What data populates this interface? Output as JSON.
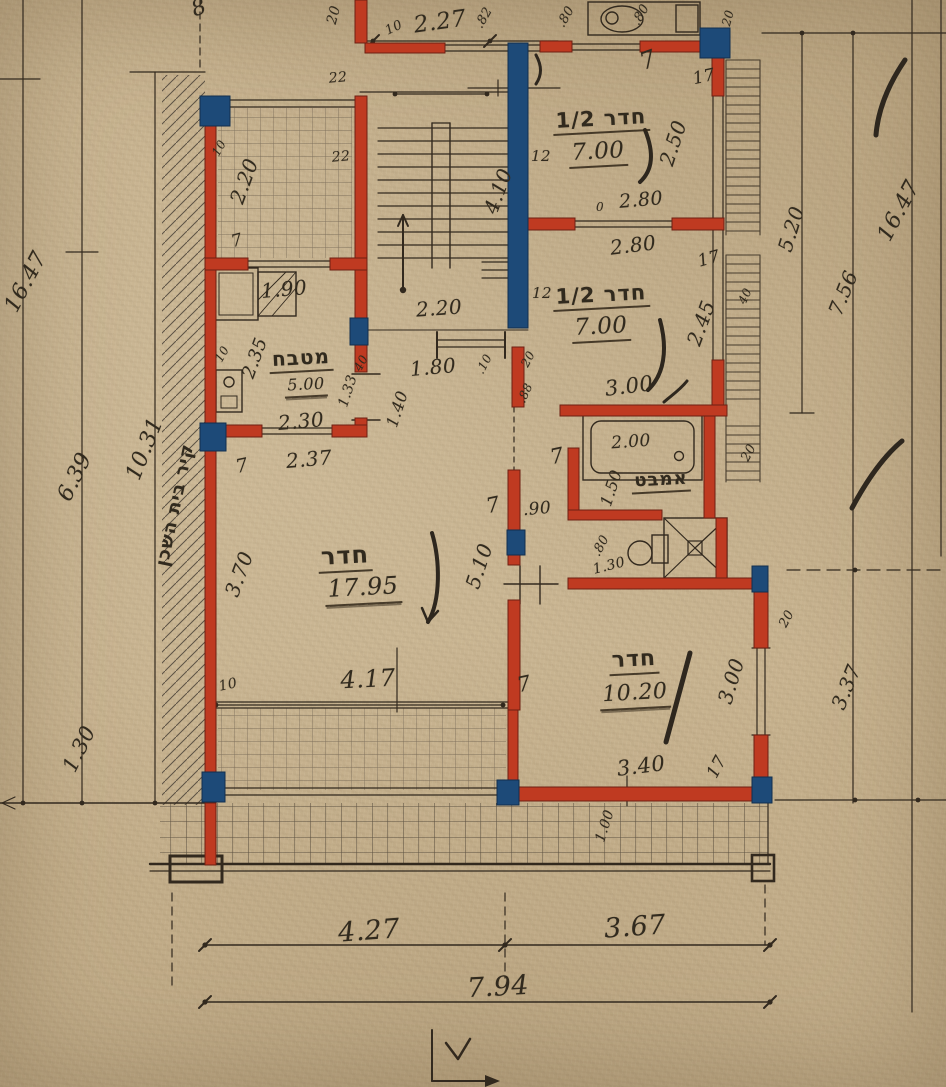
{
  "document": {
    "title": "Hand-drawn architectural floor plan, Hebrew annotations, red masonry walls and blue columns on aged paper",
    "type": "architectural-floor-plan",
    "paper_color": "#c7b28e",
    "wall_color": "#bf3a21",
    "column_color": "#1d4a78",
    "ink_color": "#32291e"
  },
  "legend": {
    "rooms": [
      {
        "label": "חדר 1/2",
        "area": "7.00"
      },
      {
        "label": "חדר 1/2",
        "area": "7.00"
      },
      {
        "label": "חדר",
        "area": "17.95"
      },
      {
        "label": "חדר",
        "area": "10.20"
      },
      {
        "label": "מטבח",
        "area": "5.00"
      },
      {
        "label": "אמבט",
        "area": ""
      }
    ],
    "notes": [
      "קיר בית השכן"
    ],
    "overall_width": "7.94",
    "overall_height": "16.47"
  },
  "labels": [
    {
      "t": "8",
      "x": 199,
      "y": 8,
      "r": -20,
      "s": 22,
      "k": "d"
    },
    {
      "t": "16.47",
      "x": 26,
      "y": 282,
      "r": -62,
      "s": 22,
      "k": "d"
    },
    {
      "t": "6.39",
      "x": 75,
      "y": 477,
      "r": -64,
      "s": 22,
      "k": "d"
    },
    {
      "t": "10.31",
      "x": 145,
      "y": 449,
      "r": -68,
      "s": 22,
      "k": "d"
    },
    {
      "t": "קיר בית השכן",
      "x": 175,
      "y": 505,
      "r": -78,
      "s": 18,
      "k": "he"
    },
    {
      "t": "1.30",
      "x": 79,
      "y": 749,
      "r": -64,
      "s": 21,
      "k": "d"
    },
    {
      "t": "20",
      "x": 334,
      "y": 15,
      "r": -75,
      "s": 14,
      "k": "d"
    },
    {
      "t": "10",
      "x": 394,
      "y": 28,
      "r": -25,
      "s": 13,
      "k": "d"
    },
    {
      "t": "2.27",
      "x": 440,
      "y": 22,
      "r": -8,
      "s": 23,
      "k": "d"
    },
    {
      "t": ".82",
      "x": 484,
      "y": 18,
      "r": -60,
      "s": 13,
      "k": "d"
    },
    {
      "t": ".80",
      "x": 566,
      "y": 17,
      "r": -60,
      "s": 13,
      "k": "d"
    },
    {
      "t": ".80",
      "x": 641,
      "y": 15,
      "r": -60,
      "s": 13,
      "k": "d"
    },
    {
      "t": "20",
      "x": 728,
      "y": 18,
      "r": -75,
      "s": 12,
      "k": "d"
    },
    {
      "t": "7",
      "x": 648,
      "y": 60,
      "r": -20,
      "s": 24,
      "k": "d"
    },
    {
      "t": "17",
      "x": 704,
      "y": 77,
      "r": -12,
      "s": 17,
      "k": "d"
    },
    {
      "t": "22",
      "x": 338,
      "y": 78,
      "r": -5,
      "s": 14,
      "k": "d"
    },
    {
      "t": "22",
      "x": 341,
      "y": 157,
      "r": -5,
      "s": 14,
      "k": "d"
    },
    {
      "t": "10",
      "x": 219,
      "y": 148,
      "r": -60,
      "s": 12,
      "k": "d"
    },
    {
      "t": "2.20",
      "x": 244,
      "y": 181,
      "r": -70,
      "s": 20,
      "k": "d"
    },
    {
      "t": "7",
      "x": 237,
      "y": 241,
      "r": -15,
      "s": 17,
      "k": "d"
    },
    {
      "t": "12",
      "x": 541,
      "y": 156,
      "r": 0,
      "s": 15,
      "k": "d"
    },
    {
      "t": "4.10",
      "x": 498,
      "y": 191,
      "r": -70,
      "s": 20,
      "k": "d"
    },
    {
      "t": "חדר 1/2",
      "x": 601,
      "y": 120,
      "r": -3,
      "s": 21,
      "k": "he u"
    },
    {
      "t": "7.00",
      "x": 598,
      "y": 153,
      "r": -3,
      "s": 23,
      "k": "d u"
    },
    {
      "t": "2.50",
      "x": 673,
      "y": 143,
      "r": -72,
      "s": 20,
      "k": "d"
    },
    {
      "t": "0",
      "x": 600,
      "y": 207,
      "r": 0,
      "s": 12,
      "k": "d"
    },
    {
      "t": "2.80",
      "x": 641,
      "y": 200,
      "r": -5,
      "s": 19,
      "k": "d"
    },
    {
      "t": "2.80",
      "x": 633,
      "y": 245,
      "r": -7,
      "s": 20,
      "k": "d"
    },
    {
      "t": "17",
      "x": 709,
      "y": 259,
      "r": -15,
      "s": 17,
      "k": "d"
    },
    {
      "t": "12",
      "x": 542,
      "y": 293,
      "r": 0,
      "s": 15,
      "k": "d"
    },
    {
      "t": "חדר 1/2",
      "x": 601,
      "y": 296,
      "r": -3,
      "s": 21,
      "k": "he u"
    },
    {
      "t": "7.00",
      "x": 601,
      "y": 328,
      "r": -3,
      "s": 23,
      "k": "d u"
    },
    {
      "t": "2.45",
      "x": 701,
      "y": 323,
      "r": -70,
      "s": 20,
      "k": "d"
    },
    {
      "t": "40",
      "x": 745,
      "y": 296,
      "r": -65,
      "s": 12,
      "k": "d"
    },
    {
      "t": "3.00",
      "x": 629,
      "y": 386,
      "r": -7,
      "s": 21,
      "k": "d"
    },
    {
      "t": "2.20",
      "x": 439,
      "y": 308,
      "r": -4,
      "s": 20,
      "k": "d"
    },
    {
      "t": "1.90",
      "x": 284,
      "y": 289,
      "r": -5,
      "s": 20,
      "k": "d"
    },
    {
      "t": "10",
      "x": 222,
      "y": 354,
      "r": -60,
      "s": 12,
      "k": "d"
    },
    {
      "t": "2.35",
      "x": 255,
      "y": 358,
      "r": -70,
      "s": 18,
      "k": "d"
    },
    {
      "t": "מטבח",
      "x": 301,
      "y": 359,
      "r": -3,
      "s": 20,
      "k": "he u"
    },
    {
      "t": "5.00",
      "x": 306,
      "y": 386,
      "r": -3,
      "s": 16,
      "k": "d u2"
    },
    {
      "t": "2.30",
      "x": 301,
      "y": 421,
      "r": -5,
      "s": 20,
      "k": "d"
    },
    {
      "t": "2.37",
      "x": 309,
      "y": 459,
      "r": -5,
      "s": 20,
      "k": "d"
    },
    {
      "t": "7",
      "x": 242,
      "y": 466,
      "r": -12,
      "s": 19,
      "k": "d"
    },
    {
      "t": "1.33",
      "x": 348,
      "y": 391,
      "r": -72,
      "s": 14,
      "k": "d"
    },
    {
      "t": "1.40",
      "x": 397,
      "y": 409,
      "r": -72,
      "s": 16,
      "k": "d"
    },
    {
      "t": "40",
      "x": 361,
      "y": 363,
      "r": -62,
      "s": 12,
      "k": "d"
    },
    {
      "t": "1.80",
      "x": 433,
      "y": 367,
      "r": -5,
      "s": 20,
      "k": "d"
    },
    {
      "t": ".10",
      "x": 484,
      "y": 364,
      "r": -62,
      "s": 12,
      "k": "d"
    },
    {
      "t": "20",
      "x": 528,
      "y": 359,
      "r": -62,
      "s": 12,
      "k": "d"
    },
    {
      "t": ".88",
      "x": 525,
      "y": 393,
      "r": -66,
      "s": 12,
      "k": "d"
    },
    {
      "t": "2.00",
      "x": 631,
      "y": 442,
      "r": -4,
      "s": 17,
      "k": "d"
    },
    {
      "t": "אמבט",
      "x": 661,
      "y": 481,
      "r": -3,
      "s": 18,
      "k": "he u"
    },
    {
      "t": "1.50",
      "x": 611,
      "y": 488,
      "r": -72,
      "s": 16,
      "k": "d"
    },
    {
      "t": "7",
      "x": 557,
      "y": 456,
      "r": -12,
      "s": 21,
      "k": "d"
    },
    {
      "t": ".90",
      "x": 537,
      "y": 509,
      "r": -5,
      "s": 17,
      "k": "d"
    },
    {
      "t": "7",
      "x": 493,
      "y": 505,
      "r": -12,
      "s": 21,
      "k": "d"
    },
    {
      "t": ".80",
      "x": 601,
      "y": 546,
      "r": -62,
      "s": 13,
      "k": "d"
    },
    {
      "t": "1.30",
      "x": 609,
      "y": 566,
      "r": -14,
      "s": 14,
      "k": "d"
    },
    {
      "t": "20",
      "x": 749,
      "y": 453,
      "r": -62,
      "s": 13,
      "k": "d"
    },
    {
      "t": "20",
      "x": 787,
      "y": 619,
      "r": -62,
      "s": 13,
      "k": "d"
    },
    {
      "t": "חדר",
      "x": 345,
      "y": 557,
      "r": -3,
      "s": 24,
      "k": "he u"
    },
    {
      "t": "17.95",
      "x": 363,
      "y": 589,
      "r": -3,
      "s": 24,
      "k": "d u2"
    },
    {
      "t": "3.70",
      "x": 239,
      "y": 574,
      "r": -70,
      "s": 20,
      "k": "d"
    },
    {
      "t": "5.10",
      "x": 479,
      "y": 566,
      "r": -72,
      "s": 20,
      "k": "d"
    },
    {
      "t": "4.17",
      "x": 368,
      "y": 679,
      "r": -3,
      "s": 24,
      "k": "d"
    },
    {
      "t": "10",
      "x": 228,
      "y": 685,
      "r": -12,
      "s": 14,
      "k": "d"
    },
    {
      "t": "7",
      "x": 524,
      "y": 684,
      "r": -12,
      "s": 21,
      "k": "d"
    },
    {
      "t": "חדר",
      "x": 634,
      "y": 661,
      "r": -3,
      "s": 22,
      "k": "he u"
    },
    {
      "t": "10.20",
      "x": 635,
      "y": 695,
      "r": -3,
      "s": 22,
      "k": "d u2"
    },
    {
      "t": "3.00",
      "x": 731,
      "y": 681,
      "r": -73,
      "s": 20,
      "k": "d"
    },
    {
      "t": "3.40",
      "x": 641,
      "y": 766,
      "r": -7,
      "s": 21,
      "k": "d"
    },
    {
      "t": "17",
      "x": 717,
      "y": 767,
      "r": -62,
      "s": 17,
      "k": "d"
    },
    {
      "t": "1.00",
      "x": 605,
      "y": 826,
      "r": -72,
      "s": 14,
      "k": "d"
    },
    {
      "t": "3.37",
      "x": 846,
      "y": 687,
      "r": -68,
      "s": 20,
      "k": "d"
    },
    {
      "t": "5.20",
      "x": 791,
      "y": 229,
      "r": -73,
      "s": 20,
      "k": "d"
    },
    {
      "t": "7.56",
      "x": 843,
      "y": 293,
      "r": -68,
      "s": 20,
      "k": "d"
    },
    {
      "t": "16.47",
      "x": 899,
      "y": 211,
      "r": -62,
      "s": 22,
      "k": "d"
    },
    {
      "t": "4.27",
      "x": 369,
      "y": 931,
      "r": -4,
      "s": 27,
      "k": "d"
    },
    {
      "t": "3.67",
      "x": 635,
      "y": 927,
      "r": -4,
      "s": 27,
      "k": "d"
    },
    {
      "t": "7.94",
      "x": 498,
      "y": 987,
      "r": -3,
      "s": 27,
      "k": "d"
    }
  ]
}
